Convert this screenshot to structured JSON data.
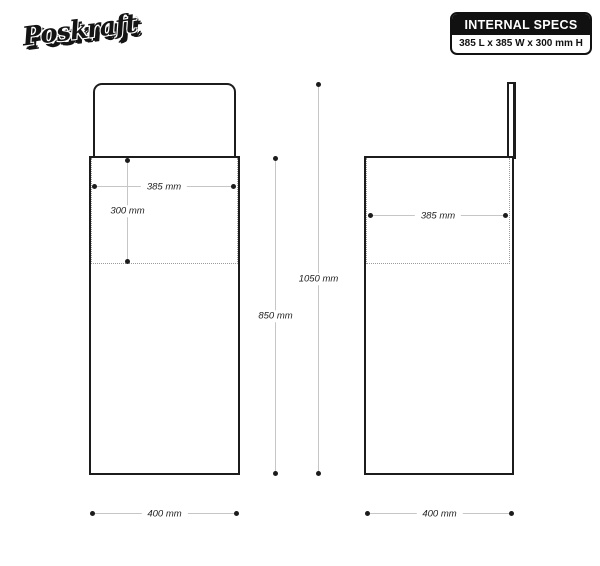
{
  "logo": {
    "text": "Poskraft"
  },
  "specs_box": {
    "title": "INTERNAL SPECS",
    "value": "385 L x 385 W x 300 mm H"
  },
  "dimensions": {
    "front_internal_width": "385 mm",
    "front_internal_height": "300 mm",
    "front_body_height": "850 mm",
    "front_total_height": "1050 mm",
    "front_base_width": "400 mm",
    "side_internal_depth": "385 mm",
    "side_base_depth": "400 mm"
  },
  "colors": {
    "ink": "#1c1c1c",
    "dim_line": "#c6c6c6",
    "dotted_line": "#9b9b9b",
    "background": "#ffffff"
  }
}
